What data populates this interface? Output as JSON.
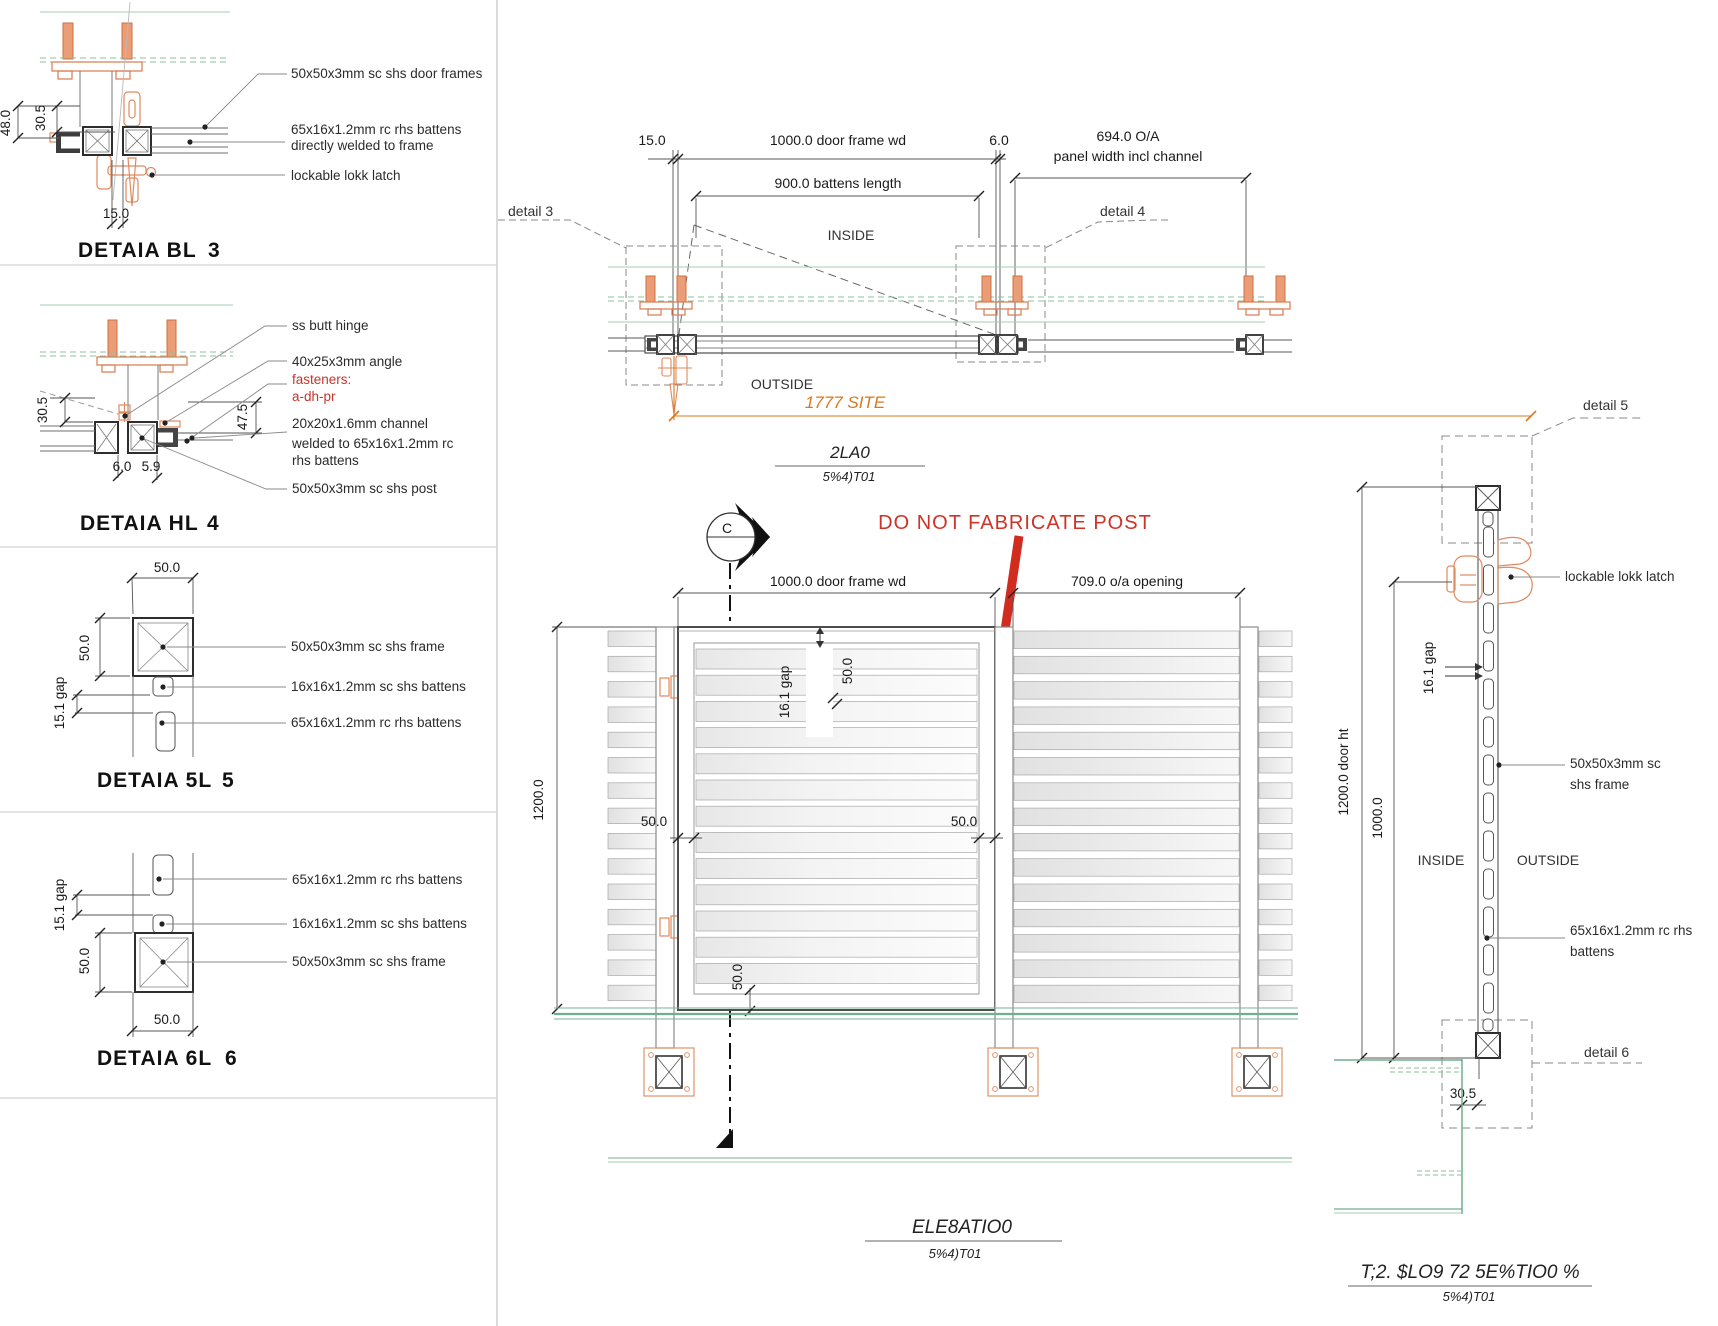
{
  "colors": {
    "accent_orange": "#d9781e",
    "hardware_orange": "#e08a5e",
    "warning_red": "#cf3226",
    "drawing_green": "#79b191",
    "line_dark": "#4d4d4d"
  },
  "detail3": {
    "title": "DETAIA BL",
    "number": "3",
    "dim_48": "48.0",
    "dim_305": "30.5",
    "dim_15": "15.0",
    "label_frames": "50x50x3mm sc shs door frames",
    "label_battens_1": "65x16x1.2mm rc rhs battens",
    "label_battens_2": "directly welded to frame",
    "label_latch": "lockable lokk latch"
  },
  "detail4": {
    "title": "DETAIA HL",
    "number": "4",
    "dim_305": "30.5",
    "dim_475": "47.5",
    "dim_6": "6.0",
    "dim_59": "5.9",
    "label_hinge": "ss butt hinge",
    "label_angle": "40x25x3mm angle",
    "label_fasteners_1": "fasteners:",
    "label_fasteners_2": "a-dh-pr",
    "label_channel_1": "20x20x1.6mm channel",
    "label_channel_2": "welded to 65x16x1.2mm rc",
    "label_channel_3": "rhs battens",
    "label_post": "50x50x3mm sc shs post"
  },
  "detail5": {
    "title": "DETAIA 5L",
    "number": "5",
    "dim_w": "50.0",
    "dim_h": "50.0",
    "dim_gap": "15.1 gap",
    "label_frame": "50x50x3mm sc shs frame",
    "label_shs": "16x16x1.2mm sc shs battens",
    "label_rhs": "65x16x1.2mm rc rhs battens"
  },
  "detail6": {
    "title": "DETAIA 6L",
    "number": "6",
    "dim_w": "50.0",
    "dim_h": "50.0",
    "dim_gap": "15.1 gap",
    "label_rhs": "65x16x1.2mm rc rhs battens",
    "label_shs": "16x16x1.2mm sc shs battens",
    "label_frame": "50x50x3mm sc shs frame"
  },
  "plan": {
    "dim_15": "15.0",
    "dim_frame": "1000.0 door frame wd",
    "dim_6": "6.0",
    "dim_oa_1": "694.0 O/A",
    "dim_oa_2": "panel width incl channel",
    "dim_battens": "900.0 battens length",
    "inside": "INSIDE",
    "outside": "OUTSIDE",
    "detail3_ref": "detail 3",
    "detail4_ref": "detail 4",
    "site_dim": "1777 SITE",
    "title": "2LA0",
    "scale": "5%4)T01"
  },
  "elevation": {
    "warning": "DO NOT FABRICATE POST",
    "dim_frame": "1000.0 door frame wd",
    "dim_opening": "709.0 o/a opening",
    "dim_gap": "16.1 gap",
    "dim_50_top": "50.0",
    "dim_50_left": "50.0",
    "dim_50_right": "50.0",
    "dim_50_bottom": "50.0",
    "dim_height": "1200.0",
    "marker": "C",
    "title": "ELE8ATIO0",
    "scale": "5%4)T01"
  },
  "side": {
    "detail5_ref": "detail 5",
    "detail6_ref": "detail 6",
    "label_latch": "lockable lokk latch",
    "label_frame_1": "50x50x3mm sc",
    "label_frame_2": "shs frame",
    "label_battens_1": "65x16x1.2mm rc rhs",
    "label_battens_2": "battens",
    "dim_height": "1200.0 door ht",
    "dim_1000": "1000.0",
    "dim_gap": "16.1 gap",
    "inside": "INSIDE",
    "outside": "OUTSIDE",
    "dim_305": "30.5",
    "title": "T;2. $LO9 72 5E%TIO0 %",
    "scale": "5%4)T01"
  }
}
